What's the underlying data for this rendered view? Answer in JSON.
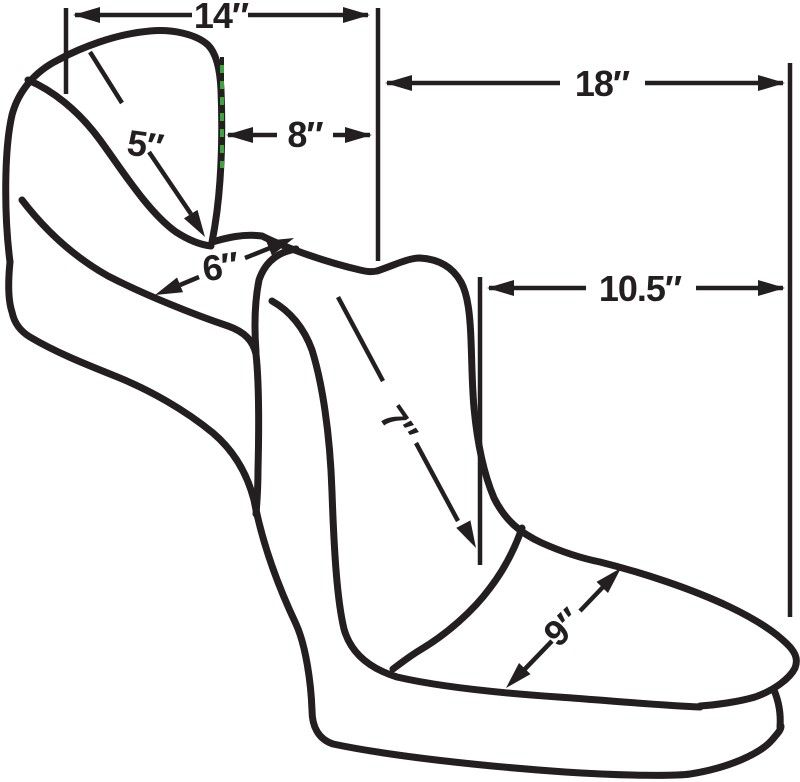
{
  "colors": {
    "ink": "#231F20",
    "accent_green": "#3BA43B",
    "background": "#FFFFFF"
  },
  "dimensions": {
    "backrest_width": {
      "label": "14″"
    },
    "rear_span": {
      "label": "18″"
    },
    "backrest_to_post": {
      "label": "8″"
    },
    "backrest_height": {
      "label": "5″"
    },
    "saddle_width": {
      "label": "6″"
    },
    "passenger_span": {
      "label": "10.5″"
    },
    "passenger_drop": {
      "label": "7″"
    },
    "passenger_length": {
      "label": "9″"
    }
  }
}
